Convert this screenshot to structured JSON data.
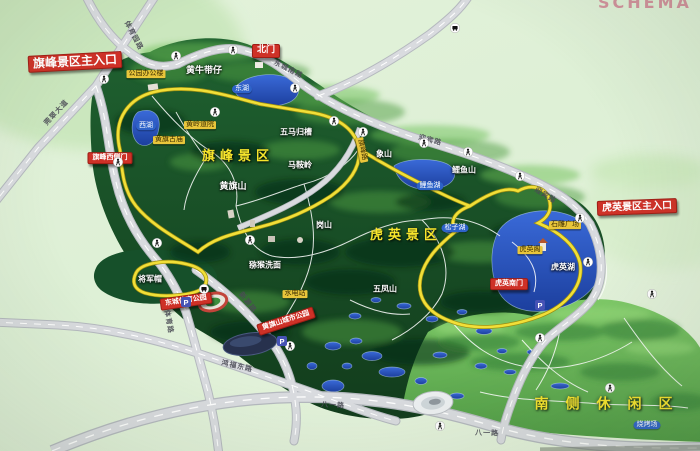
{
  "title_partial": "SCHEMA",
  "colors": {
    "board_green": "#def0d6",
    "park_green": "#1c5a2c",
    "hill_green": "#6fbf5b",
    "lake_blue": "#2b55c8",
    "route_yellow": "#f1df38",
    "label_red": "#ce3127",
    "tag_yellow": "#e9c63b",
    "area_text_yellow": "#f7e52c"
  },
  "area_titles": [
    {
      "name": "area-title-qifeng",
      "text": "旗峰景区",
      "x": 238,
      "y": 157,
      "fs": 13,
      "ls": 5
    },
    {
      "name": "area-title-huying",
      "text": "虎英景区",
      "x": 406,
      "y": 236,
      "fs": 13,
      "ls": 5
    },
    {
      "name": "area-title-south-leisure",
      "text": "南侧休闲区",
      "x": 612,
      "y": 405,
      "fs": 14,
      "ls": 17
    }
  ],
  "red_labels": [
    {
      "name": "qifeng-main-entrance-label",
      "text": "旗峰景区主入口",
      "x": 75,
      "y": 62,
      "fs": 12,
      "rot": -3
    },
    {
      "name": "north-gate-label",
      "text": "北门",
      "x": 266,
      "y": 51,
      "fs": 9
    },
    {
      "name": "huying-main-entrance-label",
      "text": "虎英景区主入口",
      "x": 637,
      "y": 207,
      "fs": 10,
      "rot": -2
    },
    {
      "name": "qifeng-west-gate-label",
      "text": "旗峰西侧门",
      "x": 110,
      "y": 158,
      "fs": 7
    },
    {
      "name": "huying-south-gate-label",
      "text": "虎英南门",
      "x": 509,
      "y": 284,
      "fs": 7
    },
    {
      "name": "dongcheng-sports-park-label",
      "text": "东城体育公园",
      "x": 186,
      "y": 301,
      "fs": 7,
      "rot": -8
    },
    {
      "name": "huangqishan-city-park-label",
      "text": "黄旗山城市公园",
      "x": 286,
      "y": 321,
      "fs": 7,
      "rot": -18
    }
  ],
  "place_labels": [
    {
      "name": "place-huangniudaizai",
      "text": "黄牛带仔",
      "x": 204,
      "y": 72,
      "fs": 9
    },
    {
      "name": "place-wumaguicao",
      "text": "五马归槽",
      "x": 296,
      "y": 133,
      "fs": 8
    },
    {
      "name": "place-maanling",
      "text": "马鞍岭",
      "x": 300,
      "y": 166,
      "fs": 8
    },
    {
      "name": "place-xiangshan",
      "text": "象山",
      "x": 384,
      "y": 155,
      "fs": 8
    },
    {
      "name": "place-liyushan",
      "text": "鲤鱼山",
      "x": 464,
      "y": 171,
      "fs": 8
    },
    {
      "name": "place-huangqishan",
      "text": "黄旗山",
      "x": 233,
      "y": 188,
      "fs": 9
    },
    {
      "name": "place-gangshan",
      "text": "岗山",
      "x": 324,
      "y": 226,
      "fs": 8
    },
    {
      "name": "place-mihouximian",
      "text": "猕猴洗面",
      "x": 265,
      "y": 266,
      "fs": 8
    },
    {
      "name": "place-wufengshan",
      "text": "五凤山",
      "x": 385,
      "y": 290,
      "fs": 8
    },
    {
      "name": "place-jiangjunmao",
      "text": "将军帽",
      "x": 150,
      "y": 280,
      "fs": 8
    },
    {
      "name": "huying-lake-name",
      "text": "虎英湖",
      "x": 563,
      "y": 268,
      "fs": 8
    }
  ],
  "facility_tags": [
    {
      "name": "tag-park-office",
      "text": "公园办公楼",
      "x": 146,
      "y": 74
    },
    {
      "name": "tag-huangling-temple",
      "text": "黄岭道院",
      "x": 200,
      "y": 125
    },
    {
      "name": "tag-huangqi-temple",
      "text": "黄旗古庙",
      "x": 169,
      "y": 140
    },
    {
      "name": "tag-hydro-station",
      "text": "水电站",
      "x": 295,
      "y": 294
    },
    {
      "name": "tag-stone-plaza",
      "text": "石雕广场",
      "x": 565,
      "y": 225
    },
    {
      "name": "tag-huying-pavilion",
      "text": "虎英阁",
      "x": 530,
      "y": 250
    }
  ],
  "lake_tags": [
    {
      "name": "lake-tag-east-lake",
      "text": "东湖",
      "x": 242,
      "y": 89
    },
    {
      "name": "lake-tag-west-lake",
      "text": "西湖",
      "x": 146,
      "y": 126
    },
    {
      "name": "lake-tag-liyu-lake",
      "text": "鲤鱼湖",
      "x": 430,
      "y": 186
    },
    {
      "name": "lake-tag-songzi-lake",
      "text": "松子湖",
      "x": 455,
      "y": 228
    },
    {
      "name": "lake-tag-bbq-area",
      "text": "烧烤场",
      "x": 647,
      "y": 425
    }
  ],
  "road_labels": [
    {
      "name": "road-tiyuyuan",
      "text": "体育园路",
      "x": 133,
      "y": 36,
      "rot": 62
    },
    {
      "name": "road-guancui-avenue",
      "text": "莞翠大道",
      "x": 57,
      "y": 113,
      "rot": -47
    },
    {
      "name": "road-dongchengnan",
      "text": "东城南路",
      "x": 288,
      "y": 70,
      "rot": 27
    },
    {
      "name": "road-yingbin-1",
      "text": "迎宾路",
      "x": 430,
      "y": 141,
      "rot": 15
    },
    {
      "name": "road-yingbin-2",
      "text": "迎宾路",
      "x": 545,
      "y": 196,
      "rot": 32
    },
    {
      "name": "road-qifeng",
      "text": "旗峰路",
      "x": 362,
      "y": 150,
      "rot": 78,
      "style": "yellow"
    },
    {
      "name": "road-xinyuan",
      "text": "新源路",
      "x": 247,
      "y": 303,
      "rot": 52
    },
    {
      "name": "road-tiyu",
      "text": "体育路",
      "x": 168,
      "y": 322,
      "rot": 80
    },
    {
      "name": "road-hongfudong",
      "text": "鸿福东路",
      "x": 237,
      "y": 367,
      "rot": 13
    },
    {
      "name": "road-bayi-1",
      "text": "八一路",
      "x": 333,
      "y": 406,
      "rot": 4
    },
    {
      "name": "road-bayi-2",
      "text": "八一路",
      "x": 487,
      "y": 434,
      "rot": 2
    }
  ],
  "icons": {
    "walker": [
      [
        104,
        79
      ],
      [
        233,
        50
      ],
      [
        295,
        88
      ],
      [
        334,
        121
      ],
      [
        424,
        143
      ],
      [
        520,
        176
      ],
      [
        580,
        218
      ],
      [
        118,
        162
      ],
      [
        215,
        112
      ],
      [
        363,
        132
      ],
      [
        250,
        240
      ],
      [
        157,
        243
      ],
      [
        588,
        262
      ],
      [
        540,
        338
      ],
      [
        610,
        388
      ],
      [
        290,
        346
      ],
      [
        440,
        426
      ],
      [
        652,
        294
      ],
      [
        176,
        56
      ],
      [
        468,
        152
      ]
    ],
    "parking": [
      [
        186,
        302
      ],
      [
        282,
        341
      ],
      [
        540,
        305
      ]
    ],
    "bus": [
      [
        204,
        289
      ],
      [
        455,
        28
      ]
    ]
  }
}
